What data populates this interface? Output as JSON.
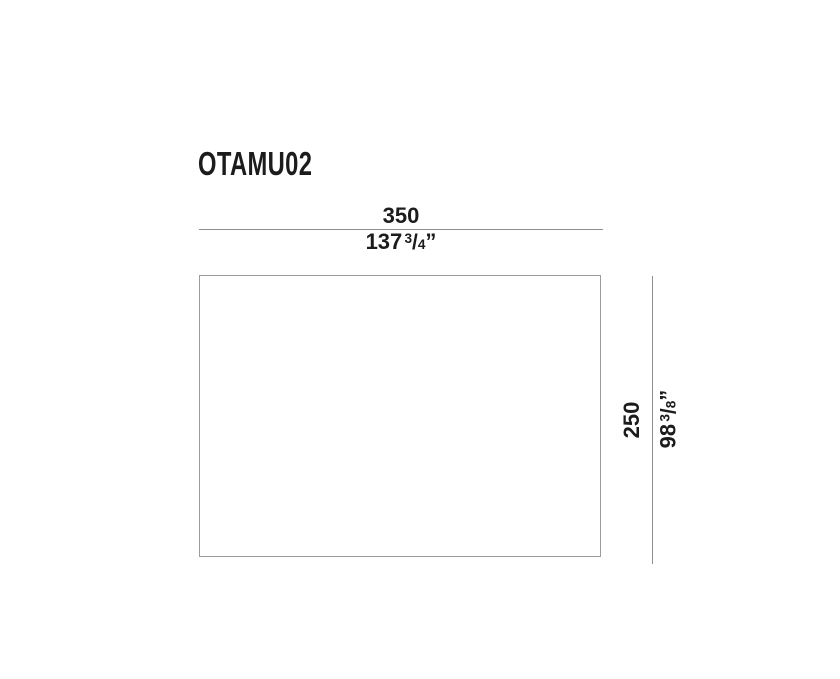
{
  "drawing": {
    "product_code": "OTAMU02",
    "width": {
      "cm": "350",
      "inch_whole": "137",
      "frac_numerator": "3",
      "frac_slash": "/",
      "frac_denominator": "4",
      "inch_mark": "”"
    },
    "height": {
      "cm": "250",
      "inch_whole": "98",
      "frac_numerator": "3",
      "frac_slash": "/",
      "frac_denominator": "8",
      "inch_mark": "”"
    }
  },
  "colors": {
    "text": "#1c1c1c",
    "dimension_line": "#8f8f8f",
    "outline_border": "#9c9c9c",
    "background": "#ffffff"
  }
}
